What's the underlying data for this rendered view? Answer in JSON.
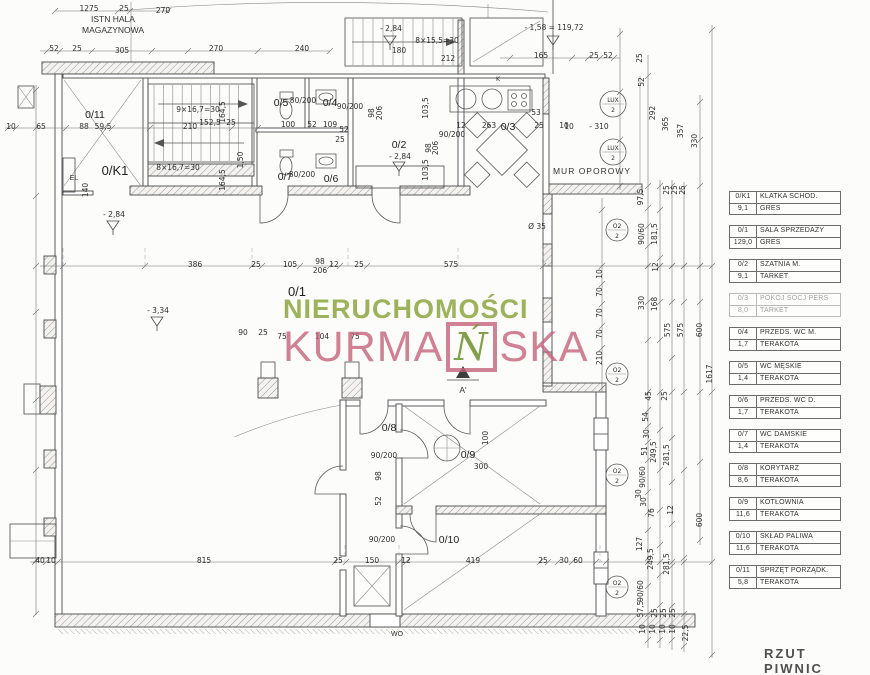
{
  "title": "RZUT PIWNIC",
  "watermark": {
    "line1": "NIERUCHOMOŚCI",
    "kurma_pre": "KURMA",
    "kurma_boxed": "Ń",
    "kurma_post": "SKA",
    "color_green": "#8ba53e",
    "color_pink": "#c4637b"
  },
  "labels": {
    "hall_line1": "ISTN HALA",
    "hall_line2": "MAGAZYNOWA",
    "retaining_wall": "MUR OPOROWY",
    "elevator": "EL",
    "coal_chute": "WO",
    "section": "A'"
  },
  "plan": {
    "rooms": [
      {
        "id": "0/11",
        "x": 95,
        "y": 118
      },
      {
        "id": "0/K1",
        "x": 115,
        "y": 175,
        "big": 1
      },
      {
        "id": "0/5",
        "x": 281,
        "y": 106
      },
      {
        "id": "0/4",
        "x": 330,
        "y": 106
      },
      {
        "id": "0/2",
        "x": 399,
        "y": 148
      },
      {
        "id": "0/3",
        "x": 508,
        "y": 130
      },
      {
        "id": "0/7",
        "x": 285,
        "y": 180
      },
      {
        "id": "0/6",
        "x": 331,
        "y": 182
      },
      {
        "id": "0/1",
        "x": 297,
        "y": 296,
        "big": 1
      },
      {
        "id": "0/8",
        "x": 389,
        "y": 431
      },
      {
        "id": "0/9",
        "x": 468,
        "y": 458
      },
      {
        "id": "0/10",
        "x": 449,
        "y": 543
      }
    ],
    "markers": [
      {
        "t1": "LUX",
        "t2": "2",
        "x": 613,
        "y": 104,
        "r": 13
      },
      {
        "t1": "LUX",
        "t2": "2",
        "x": 613,
        "y": 152,
        "r": 13
      },
      {
        "t1": "O2",
        "t2": "2",
        "x": 617,
        "y": 230,
        "r": 11
      },
      {
        "t1": "O2",
        "t2": "2",
        "x": 617,
        "y": 374,
        "r": 11
      },
      {
        "t1": "O2",
        "t2": "2",
        "x": 617,
        "y": 475,
        "r": 11
      },
      {
        "t1": "O2",
        "t2": "2",
        "x": 617,
        "y": 587,
        "r": 11
      }
    ],
    "annotations": [
      {
        "t": "1275",
        "x": 89,
        "y": 11
      },
      {
        "t": "25",
        "x": 124,
        "y": 11
      },
      {
        "t": "270",
        "x": 163,
        "y": 13
      },
      {
        "t": "52",
        "x": 54,
        "y": 51
      },
      {
        "t": "25",
        "x": 77,
        "y": 51
      },
      {
        "t": "305",
        "x": 122,
        "y": 53
      },
      {
        "t": "270",
        "x": 216,
        "y": 51
      },
      {
        "t": "240",
        "x": 302,
        "y": 51
      },
      {
        "t": "- 2,84",
        "x": 391,
        "y": 31
      },
      {
        "t": "180",
        "x": 399,
        "y": 53
      },
      {
        "t": "8×15,5=30",
        "x": 437,
        "y": 43
      },
      {
        "t": "212",
        "x": 448,
        "y": 61
      },
      {
        "t": "- 1,58 = 119,72",
        "x": 554,
        "y": 30
      },
      {
        "t": "165",
        "x": 541,
        "y": 58
      },
      {
        "t": "25",
        "x": 594,
        "y": 58
      },
      {
        "t": "52",
        "x": 608,
        "y": 58
      },
      {
        "t": "10",
        "x": 11,
        "y": 129
      },
      {
        "t": "65",
        "x": 41,
        "y": 129
      },
      {
        "t": "88",
        "x": 84,
        "y": 129
      },
      {
        "t": "59,5",
        "x": 103,
        "y": 129
      },
      {
        "t": "210",
        "x": 190,
        "y": 129
      },
      {
        "t": "9×16,7=30",
        "x": 198,
        "y": 112
      },
      {
        "t": "152,5",
        "x": 210,
        "y": 125
      },
      {
        "t": "25",
        "x": 231,
        "y": 125
      },
      {
        "t": "8×16,7=30",
        "x": 178,
        "y": 170
      },
      {
        "t": "164,5",
        "x": 225,
        "y": 112,
        "v": 1
      },
      {
        "t": "164,5",
        "x": 225,
        "y": 180,
        "v": 1
      },
      {
        "t": "1,50",
        "x": 243,
        "y": 160,
        "v": 1
      },
      {
        "t": "140",
        "x": 88,
        "y": 190,
        "v": 1
      },
      {
        "t": "- 2,84",
        "x": 114,
        "y": 217
      },
      {
        "t": "- 3,34",
        "x": 158,
        "y": 313
      },
      {
        "t": "80/200",
        "x": 303,
        "y": 103
      },
      {
        "t": "90/200",
        "x": 350,
        "y": 109
      },
      {
        "t": "80/200",
        "x": 302,
        "y": 177
      },
      {
        "t": "100",
        "x": 288,
        "y": 127
      },
      {
        "t": "52",
        "x": 312,
        "y": 127
      },
      {
        "t": "109",
        "x": 330,
        "y": 127
      },
      {
        "t": "52",
        "x": 344,
        "y": 132
      },
      {
        "t": "25",
        "x": 340,
        "y": 142
      },
      {
        "t": "98",
        "x": 374,
        "y": 113,
        "v": 1
      },
      {
        "t": "206",
        "x": 382,
        "y": 113,
        "v": 1
      },
      {
        "t": "- 2,84",
        "x": 400,
        "y": 159
      },
      {
        "t": "12",
        "x": 461,
        "y": 128
      },
      {
        "t": "263",
        "x": 489,
        "y": 128
      },
      {
        "t": "25",
        "x": 539,
        "y": 128
      },
      {
        "t": "10",
        "x": 564,
        "y": 128
      },
      {
        "t": "53",
        "x": 536,
        "y": 115
      },
      {
        "t": "90/200",
        "x": 452,
        "y": 137
      },
      {
        "t": "103,5",
        "x": 428,
        "y": 108,
        "v": 1
      },
      {
        "t": "98",
        "x": 431,
        "y": 148,
        "v": 1
      },
      {
        "t": "206",
        "x": 438,
        "y": 148,
        "v": 1
      },
      {
        "t": "103,5",
        "x": 428,
        "y": 170,
        "v": 1
      },
      {
        "t": "K",
        "x": 498,
        "y": 81,
        "s": 6
      },
      {
        "t": "- 310",
        "x": 599,
        "y": 129
      },
      {
        "t": "10",
        "x": 569,
        "y": 129
      },
      {
        "t": "Ø 35",
        "x": 537,
        "y": 229
      },
      {
        "t": "25",
        "x": 642,
        "y": 58,
        "v": 1
      },
      {
        "t": "52",
        "x": 644,
        "y": 82,
        "v": 1
      },
      {
        "t": "292",
        "x": 655,
        "y": 113,
        "v": 1
      },
      {
        "t": "365",
        "x": 668,
        "y": 124,
        "v": 1
      },
      {
        "t": "357",
        "x": 683,
        "y": 131,
        "v": 1
      },
      {
        "t": "330",
        "x": 697,
        "y": 141,
        "v": 1
      },
      {
        "t": "386",
        "x": 195,
        "y": 267
      },
      {
        "t": "25",
        "x": 256,
        "y": 267
      },
      {
        "t": "105",
        "x": 290,
        "y": 267
      },
      {
        "t": "98",
        "x": 320,
        "y": 264
      },
      {
        "t": "206",
        "x": 320,
        "y": 273
      },
      {
        "t": "12",
        "x": 334,
        "y": 267
      },
      {
        "t": "25",
        "x": 359,
        "y": 267
      },
      {
        "t": "575",
        "x": 451,
        "y": 267
      },
      {
        "t": "75",
        "x": 282,
        "y": 339
      },
      {
        "t": "104",
        "x": 322,
        "y": 339
      },
      {
        "t": "75",
        "x": 355,
        "y": 339
      },
      {
        "t": "90",
        "x": 243,
        "y": 335
      },
      {
        "t": "25",
        "x": 263,
        "y": 335
      },
      {
        "t": "90/200",
        "x": 384,
        "y": 458
      },
      {
        "t": "300",
        "x": 481,
        "y": 469
      },
      {
        "t": "100",
        "x": 488,
        "y": 438,
        "v": 1
      },
      {
        "t": "98",
        "x": 381,
        "y": 476,
        "v": 1
      },
      {
        "t": "52",
        "x": 381,
        "y": 501,
        "v": 1
      },
      {
        "t": "90/200",
        "x": 382,
        "y": 542
      },
      {
        "t": "40",
        "x": 40,
        "y": 563
      },
      {
        "t": "10",
        "x": 51,
        "y": 563
      },
      {
        "t": "815",
        "x": 204,
        "y": 563
      },
      {
        "t": "25",
        "x": 338,
        "y": 563
      },
      {
        "t": "150",
        "x": 372,
        "y": 563
      },
      {
        "t": "12",
        "x": 406,
        "y": 563
      },
      {
        "t": "419",
        "x": 473,
        "y": 563
      },
      {
        "t": "25",
        "x": 543,
        "y": 563
      },
      {
        "t": "30",
        "x": 564,
        "y": 563
      },
      {
        "t": "60",
        "x": 578,
        "y": 563
      },
      {
        "t": "97,5",
        "x": 643,
        "y": 197,
        "v": 1
      },
      {
        "t": "25",
        "x": 669,
        "y": 190,
        "v": 1
      },
      {
        "t": "25",
        "x": 677,
        "y": 190,
        "v": 1
      },
      {
        "t": "25",
        "x": 685,
        "y": 190,
        "v": 1
      },
      {
        "t": "90/60",
        "x": 644,
        "y": 234,
        "v": 1
      },
      {
        "t": "181,5",
        "x": 657,
        "y": 234,
        "v": 1
      },
      {
        "t": "12",
        "x": 658,
        "y": 267,
        "v": 1
      },
      {
        "t": "10",
        "x": 602,
        "y": 274,
        "v": 1
      },
      {
        "t": "70",
        "x": 602,
        "y": 292,
        "v": 1
      },
      {
        "t": "70",
        "x": 602,
        "y": 313,
        "v": 1
      },
      {
        "t": "70",
        "x": 602,
        "y": 334,
        "v": 1
      },
      {
        "t": "210",
        "x": 602,
        "y": 358,
        "v": 1
      },
      {
        "t": "330",
        "x": 644,
        "y": 303,
        "v": 1
      },
      {
        "t": "168",
        "x": 657,
        "y": 304,
        "v": 1
      },
      {
        "t": "575",
        "x": 670,
        "y": 330,
        "v": 1
      },
      {
        "t": "575",
        "x": 683,
        "y": 330,
        "v": 1
      },
      {
        "t": "600",
        "x": 702,
        "y": 330,
        "v": 1
      },
      {
        "t": "1617",
        "x": 712,
        "y": 374,
        "v": 1
      },
      {
        "t": "45",
        "x": 651,
        "y": 396,
        "v": 1
      },
      {
        "t": "25",
        "x": 667,
        "y": 396,
        "v": 1
      },
      {
        "t": "54",
        "x": 648,
        "y": 417,
        "v": 1
      },
      {
        "t": "30",
        "x": 649,
        "y": 434,
        "v": 1
      },
      {
        "t": "51",
        "x": 647,
        "y": 451,
        "v": 1
      },
      {
        "t": "249,5",
        "x": 656,
        "y": 452,
        "v": 1
      },
      {
        "t": "281,5",
        "x": 669,
        "y": 455,
        "v": 1
      },
      {
        "t": "90/60",
        "x": 645,
        "y": 477,
        "v": 1
      },
      {
        "t": "30",
        "x": 641,
        "y": 494,
        "v": 1
      },
      {
        "t": "30",
        "x": 646,
        "y": 502,
        "v": 1
      },
      {
        "t": "76",
        "x": 654,
        "y": 513,
        "v": 1
      },
      {
        "t": "12",
        "x": 673,
        "y": 510,
        "v": 1
      },
      {
        "t": "600",
        "x": 702,
        "y": 520,
        "v": 1
      },
      {
        "t": "127",
        "x": 642,
        "y": 544,
        "v": 1
      },
      {
        "t": "249,5",
        "x": 653,
        "y": 559,
        "v": 1
      },
      {
        "t": "281,5",
        "x": 669,
        "y": 564,
        "v": 1
      },
      {
        "t": "90/60",
        "x": 643,
        "y": 591,
        "v": 1
      },
      {
        "t": "57,5",
        "x": 643,
        "y": 609,
        "v": 1
      },
      {
        "t": "25",
        "x": 657,
        "y": 613,
        "v": 1
      },
      {
        "t": "25",
        "x": 666,
        "y": 613,
        "v": 1
      },
      {
        "t": "25",
        "x": 675,
        "y": 613,
        "v": 1
      },
      {
        "t": "10",
        "x": 645,
        "y": 629,
        "v": 1
      },
      {
        "t": "10",
        "x": 655,
        "y": 629,
        "v": 1
      },
      {
        "t": "10",
        "x": 665,
        "y": 629,
        "v": 1
      },
      {
        "t": "10",
        "x": 675,
        "y": 629,
        "v": 1
      },
      {
        "t": "22,5",
        "x": 688,
        "y": 633,
        "v": 1
      }
    ]
  },
  "legend": {
    "entries": [
      {
        "code": "0/K1",
        "name": "KLATKA SCHOD.",
        "area": "9,1",
        "floor": "GRES"
      },
      {
        "code": "0/1",
        "name": "SALA SPRZEDAŻY",
        "area": "129,0",
        "floor": "GRES"
      },
      {
        "code": "0/2",
        "name": "SZATNIA M.",
        "area": "9,1",
        "floor": "TARKET"
      },
      {
        "code": "0/3",
        "name": "POKÓJ SOCJ PERS",
        "area": "8,0",
        "floor": "TARKET",
        "faded": true
      },
      {
        "code": "0/4",
        "name": "PRZEDS. WC M.",
        "area": "1,7",
        "floor": "TERAKOTA"
      },
      {
        "code": "0/5",
        "name": "WC MĘSKIE",
        "area": "1,4",
        "floor": "TERAKOTA"
      },
      {
        "code": "0/6",
        "name": "PRZEDS. WC D.",
        "area": "1,7",
        "floor": "TERAKOTA"
      },
      {
        "code": "0/7",
        "name": "WC DAMSKIE",
        "area": "1,4",
        "floor": "TERAKOTA"
      },
      {
        "code": "0/8",
        "name": "KORYTARZ",
        "area": "8,6",
        "floor": "TERAKOTA"
      },
      {
        "code": "0/9",
        "name": "KOTŁOWNIA",
        "area": "11,6",
        "floor": "TERAKOTA"
      },
      {
        "code": "0/10",
        "name": "SKŁAD PALIWA",
        "area": "11,6",
        "floor": "TERAKOTA"
      },
      {
        "code": "0/11",
        "name": "SPRZĘT PORZĄDK.",
        "area": "5,8",
        "floor": "TERAKOTA"
      }
    ]
  }
}
